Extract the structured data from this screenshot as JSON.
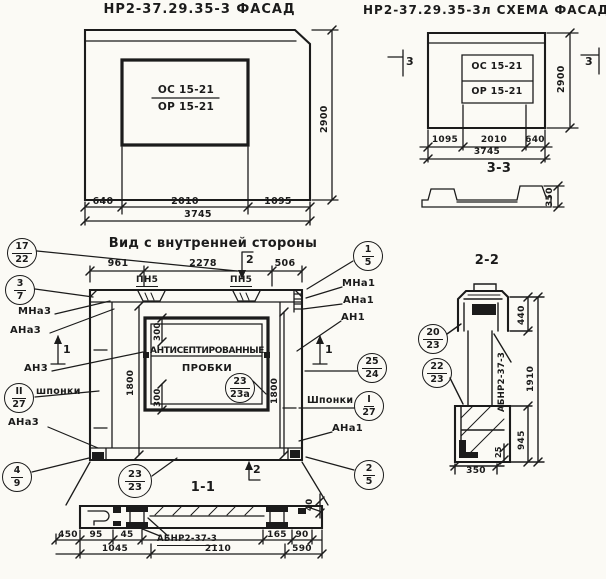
{
  "palette": {
    "paper": "#fbfaf5",
    "ink": "#1b1b1b"
  },
  "facade": {
    "title": "НР2-37.29.35-3 ФАСАД",
    "window_mark_top": "ОС 15-21",
    "window_mark_bottom": "ОР 15-21",
    "dim_640": "640",
    "dim_2010": "2010",
    "dim_1095": "1095",
    "dim_3745": "3745",
    "dim_2900": "2900"
  },
  "schema": {
    "title": "НР2-37.29.35-3л СХЕМА ФАСАДА",
    "window_mark_top": "ОС 15-21",
    "window_mark_bottom": "ОР 15-21",
    "dim_1095": "1095",
    "dim_2010": "2010",
    "dim_640": "640",
    "dim_3745": "3745",
    "dim_2900": "2900",
    "section_mark": "3",
    "section_33": {
      "label": "3-3",
      "dim_350": "350"
    }
  },
  "inner_view": {
    "title": "Вид с внутренней стороны",
    "dim_961": "961",
    "dim_2278": "2278",
    "dim_506": "506",
    "dim_300": "300",
    "dim_1800": "1800",
    "pn5": "ПН5",
    "section_2": "2",
    "section_1": "1",
    "note_line1": "АНТИСЕПТИРОВАННЫЕ",
    "note_line2": "ПРОБКИ",
    "labels": {
      "mna3": "МНа3",
      "ana3": "АНа3",
      "an3": "АН3",
      "shponki_left": "шпонки",
      "mna1": "МНа1",
      "ana1": "АНа1",
      "an1": "АН1",
      "shponki_right": "Шпонки"
    },
    "callouts": {
      "c17_22": {
        "top": "17",
        "bottom": "22"
      },
      "c3_7": {
        "top": "3",
        "bottom": "7"
      },
      "cII_27": {
        "top": "II",
        "bottom": "27"
      },
      "c4_9": {
        "top": "4",
        "bottom": "9"
      },
      "c1_5": {
        "top": "1",
        "bottom": "5"
      },
      "c25_24": {
        "top": "25",
        "bottom": "24"
      },
      "cI_27": {
        "top": "I",
        "bottom": "27"
      },
      "c2_5": {
        "top": "2",
        "bottom": "5"
      },
      "c23_23a": {
        "top": "23",
        "bottom": "23а"
      },
      "c23_23": {
        "top": "23",
        "bottom": "23"
      }
    }
  },
  "section_11": {
    "label": "1-1",
    "part_mark": "АБНР2-37-3",
    "dims": {
      "d450": "450",
      "d95": "95",
      "d45": "45",
      "d1045": "1045",
      "d2110": "2110",
      "d165": "165",
      "d90": "90",
      "d590": "590",
      "d40": "40"
    }
  },
  "section_22": {
    "label": "2-2",
    "part_mark": "АБНР2-37-3",
    "dims": {
      "d440": "440",
      "d1910": "1910",
      "d945": "945",
      "d25": "25",
      "d350": "350"
    },
    "callouts": {
      "c20_23": {
        "top": "20",
        "bottom": "23"
      },
      "c22_23": {
        "top": "22",
        "bottom": "23"
      }
    }
  }
}
